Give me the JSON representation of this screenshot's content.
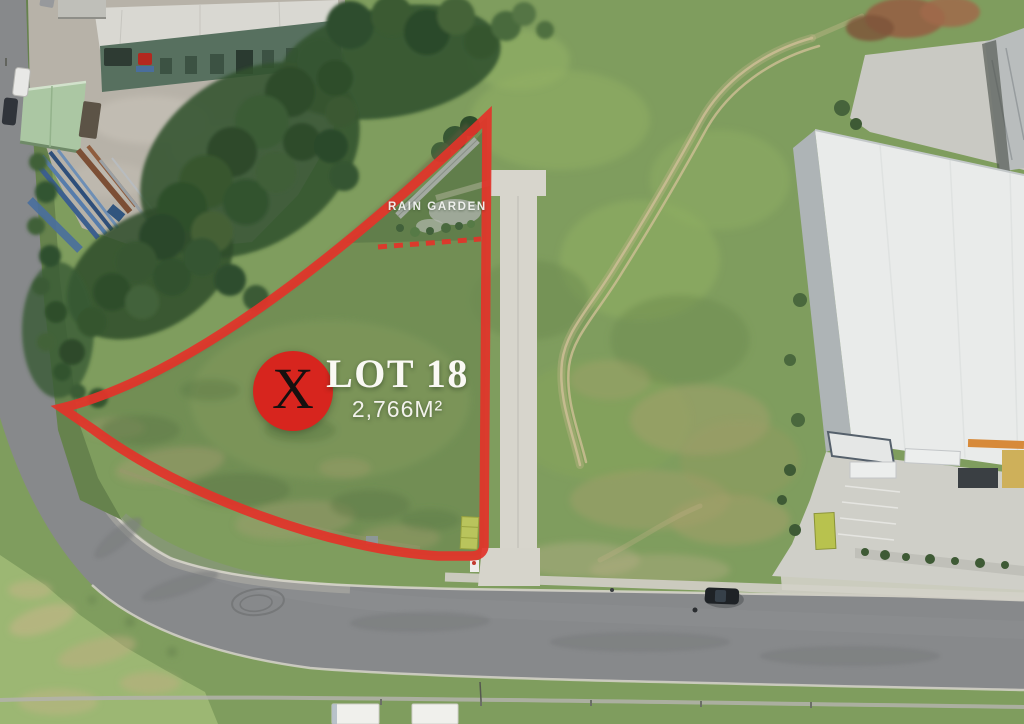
{
  "annotations": {
    "logo_letter": "X",
    "lot_label": "LOT 18",
    "lot_area": "2,766M²",
    "rain_garden_label": "RAIN GARDEN"
  },
  "colors": {
    "boundary_red": "#e2342a",
    "logo_red": "#d7251e",
    "logo_letter_color": "#16100f",
    "label_white": "#faf9f4"
  }
}
